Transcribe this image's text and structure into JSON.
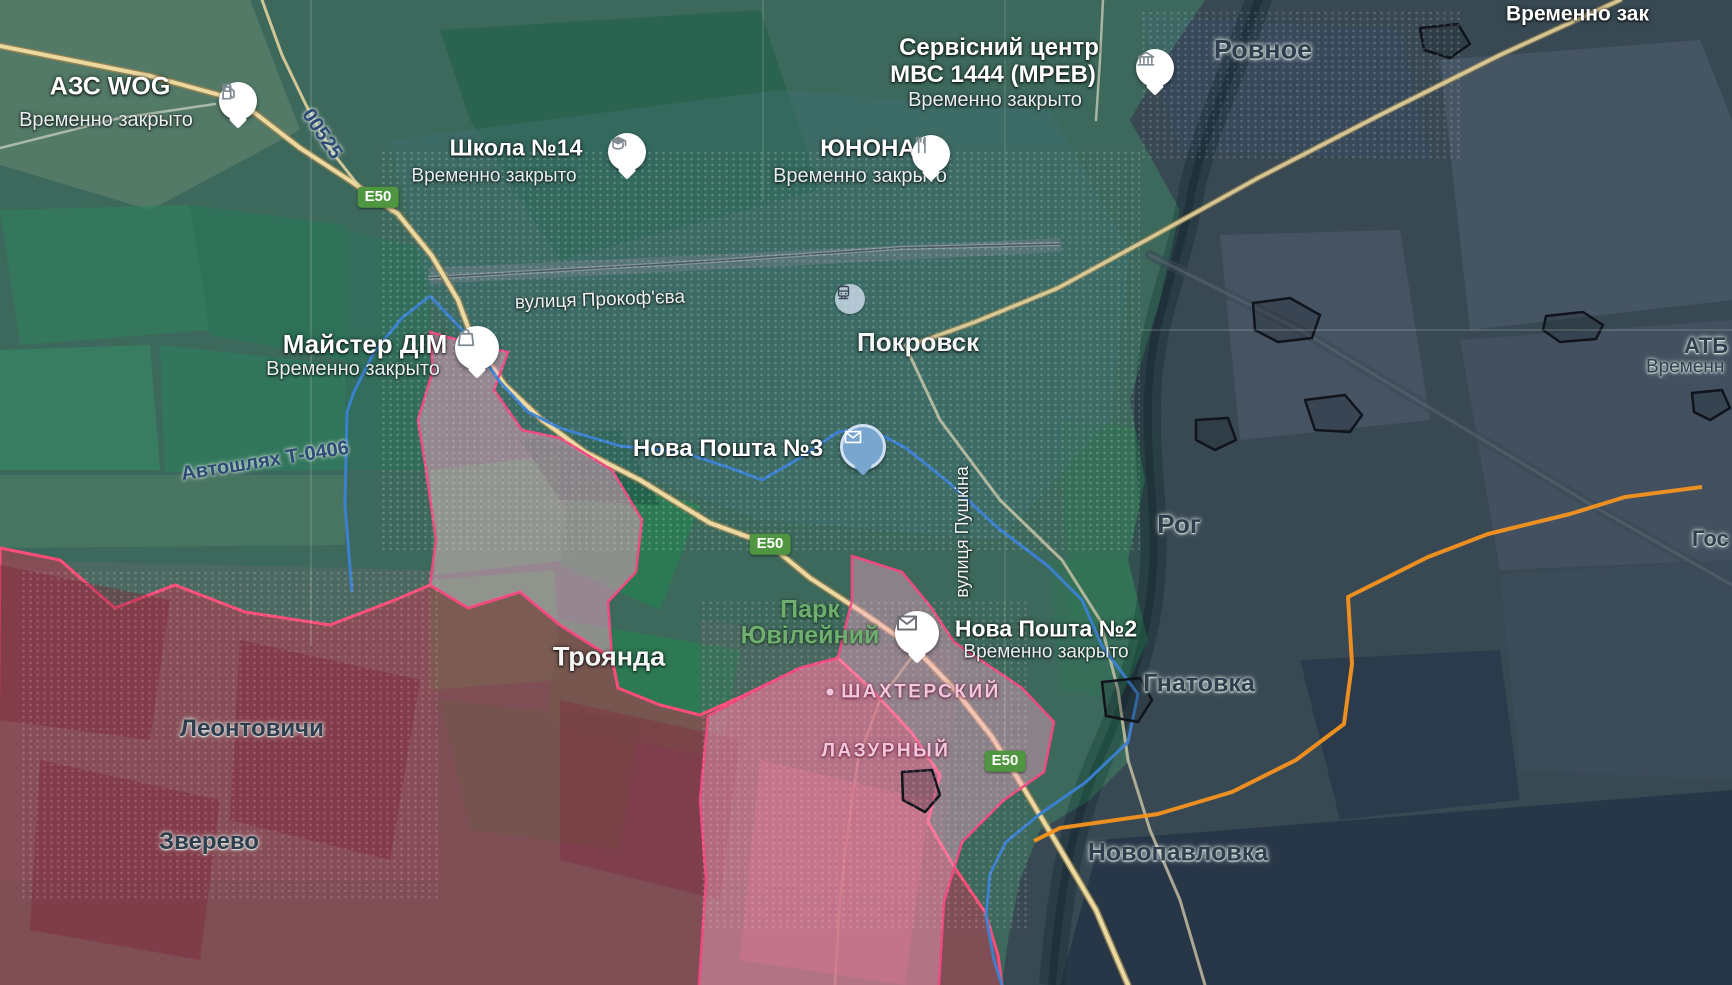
{
  "colors": {
    "teal_overlay": "#1f6e5e",
    "dark_overlay": "#1e2d4a",
    "red_zone_fill": "#c4344e",
    "red_zone_border": "#ff4d79",
    "pink_zone_fill": "#f7a8c8",
    "pink_zone_border": "#ef4a80",
    "blue_boundary": "#3b82d4",
    "orange_line": "#f5941e",
    "road_yellow": "#ecd9a0",
    "e50_badge_green": "#4f9641"
  },
  "badges": {
    "e50": "E50"
  },
  "roads": {
    "n00525": "00525",
    "avtoshliakh": "Автошлях Т-0406"
  },
  "streets": {
    "prokofieva": "вулиця Прокоф'єва",
    "pushkina": "вулиця Пушкіна"
  },
  "towns": {
    "pokrovsk": "Покровск",
    "rovnoe": "Ровное",
    "rog": "Рог",
    "gnatovka": "Гнатовка",
    "troianda": "Троянда",
    "leontovychi": "Леонтовичи",
    "zverevo": "Зверево",
    "novopavlovka": "Новопавловка"
  },
  "districts": {
    "shakhterskyi": "ШАХТЕРСКИЙ",
    "lazurnyi": "ЛАЗУРНЫЙ"
  },
  "park": {
    "line1": "Парк",
    "line2": "Ювілейний"
  },
  "pois": {
    "azs": {
      "name": "АЗС WOG",
      "status": "Временно закрыто"
    },
    "school": {
      "name": "Школа №14",
      "status": "Временно закрыто"
    },
    "mvs": {
      "line1": "Сервісний центр",
      "line2": "МВС 1444 (МРЕВ)",
      "status": "Временно закрыто"
    },
    "yunona": {
      "name": "ЮНОНА",
      "status": "Временно закрыто"
    },
    "maister": {
      "name": "Майстер ДІМ",
      "status": "Временно закрыто"
    },
    "np3": {
      "name": "Нова Пошта №3"
    },
    "np2": {
      "name": "Нова Пошта №2",
      "status": "Временно закрыто"
    }
  },
  "partials": {
    "top_right": "Временно зак",
    "atb": "АТБ",
    "atb_status": "Временн",
    "gos": "Гос"
  }
}
